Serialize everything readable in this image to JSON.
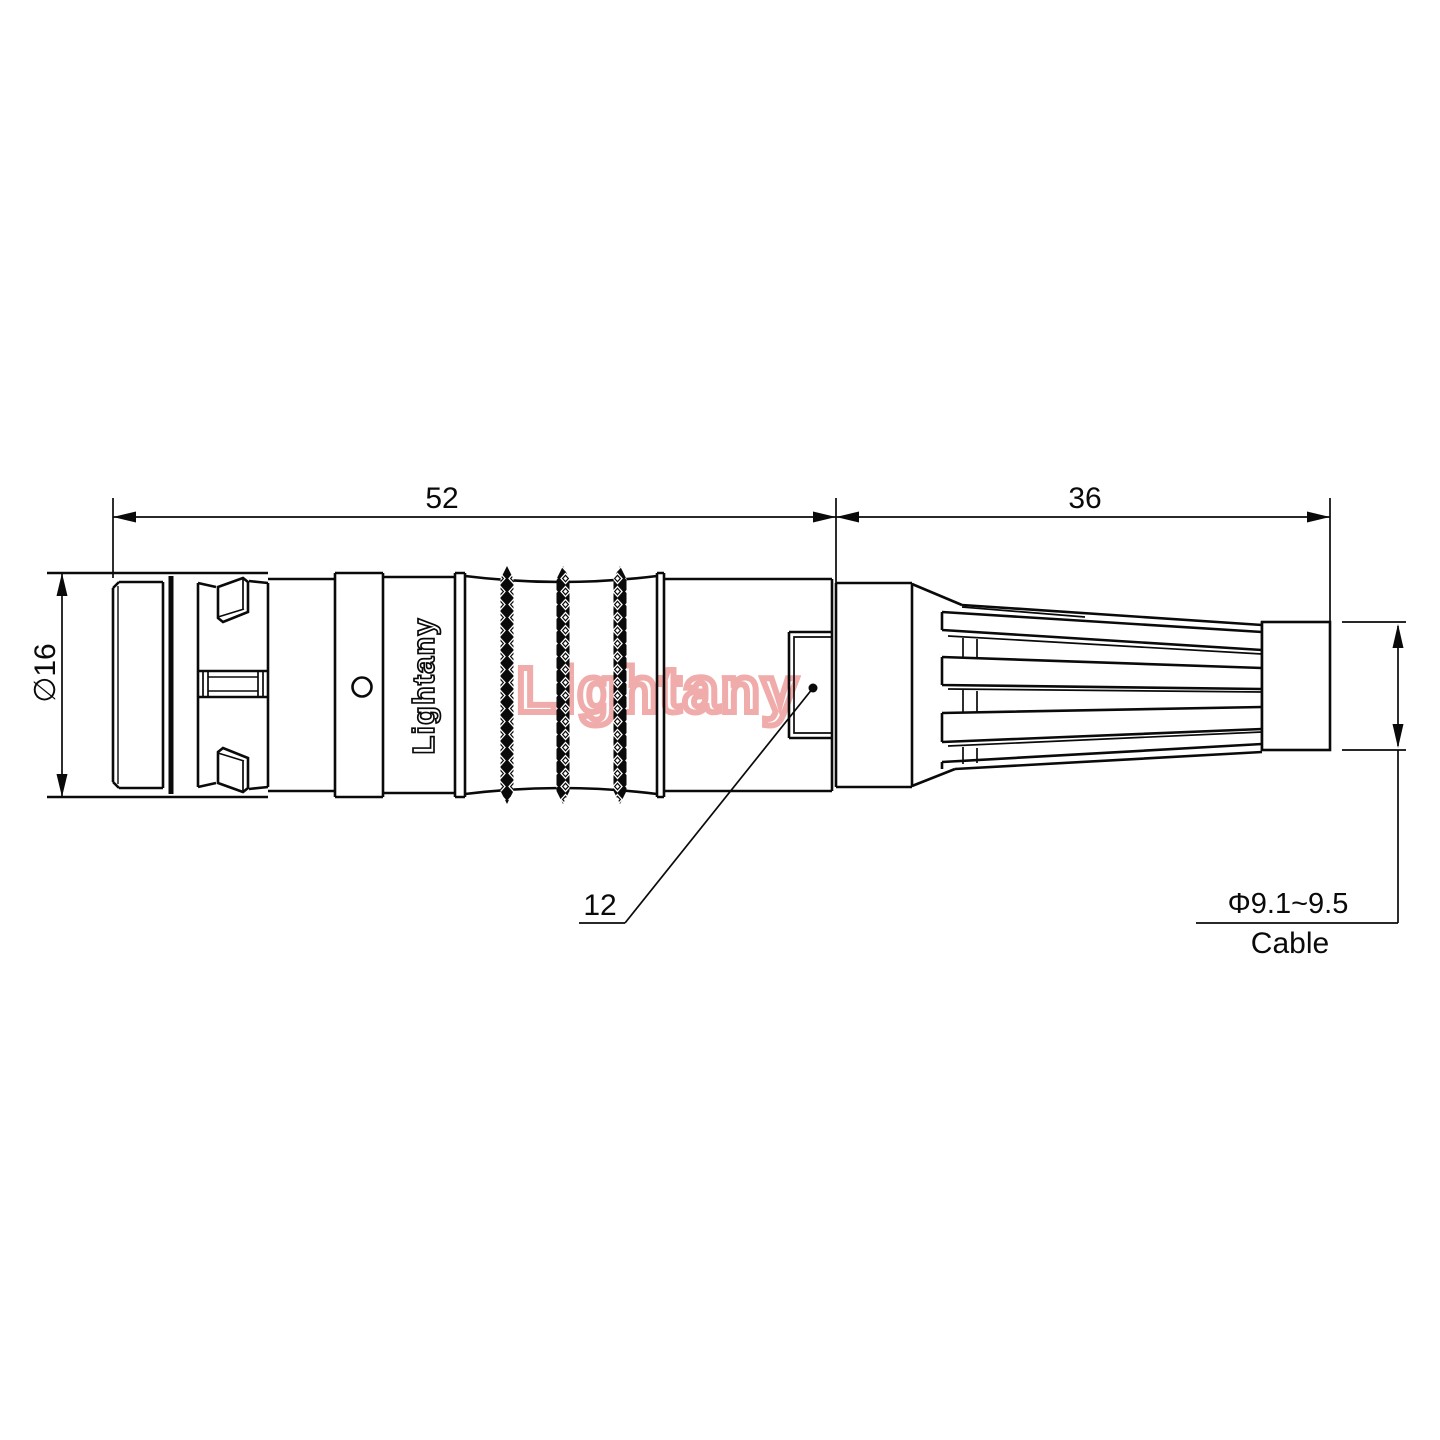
{
  "drawing": {
    "type": "connector-technical-drawing",
    "dimensions": {
      "front_length": "52",
      "rear_length": "36",
      "body_diameter": "∅16",
      "window_callout": "12",
      "cable_diameter": "Φ9.1~9.5",
      "cable_label": "Cable"
    },
    "branding": {
      "body_label": "Lightany",
      "watermark": "Lightany"
    },
    "colors": {
      "line": "#0a0a0a",
      "watermark_pink": "#efa3a3",
      "background": "#ffffff"
    }
  }
}
